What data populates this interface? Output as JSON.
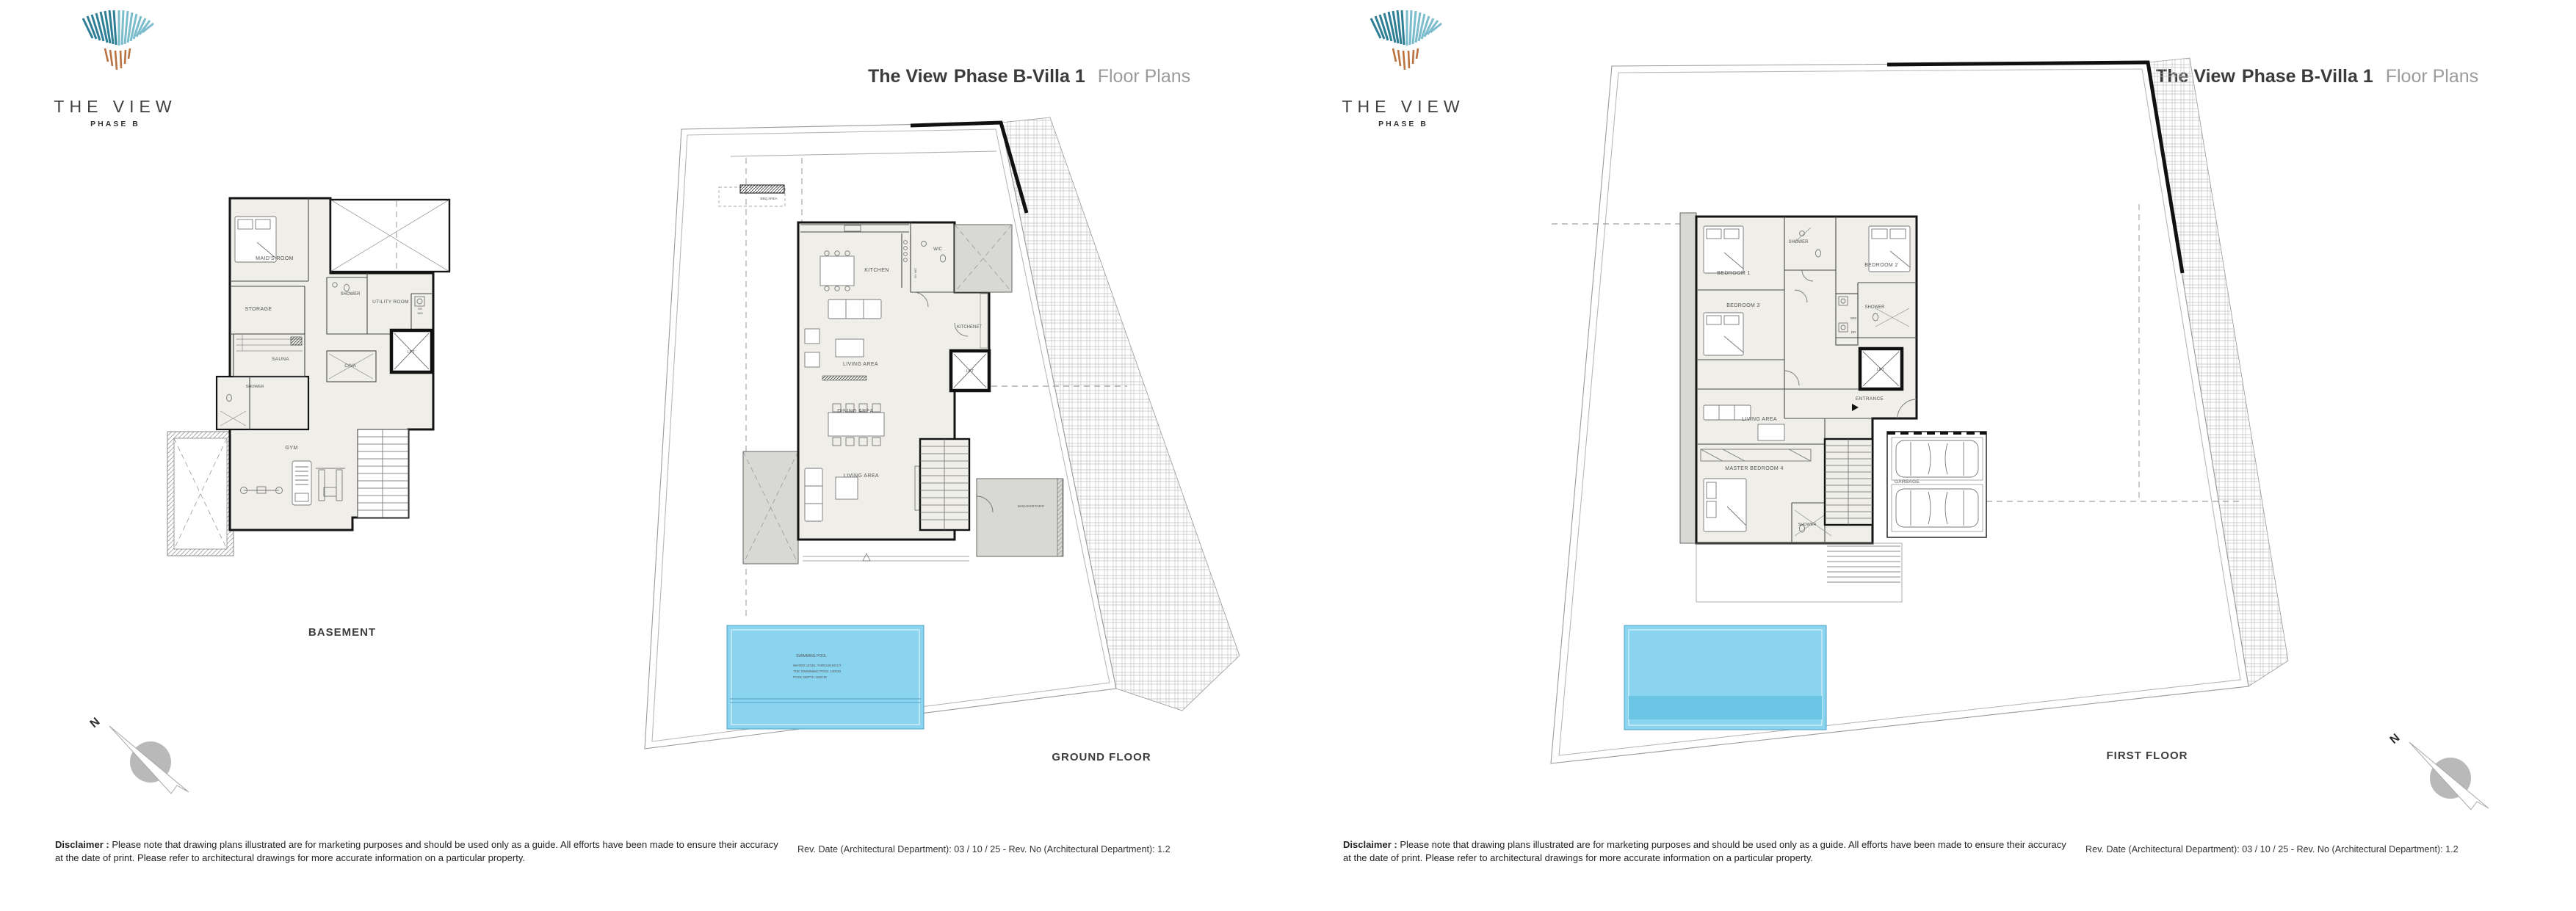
{
  "branding": {
    "logo_title": "THE VIEW",
    "logo_subtitle": "PHASE B"
  },
  "title": {
    "project": "The View",
    "unit": "Phase B-Villa 1",
    "suffix": "Floor Plans"
  },
  "compass": {
    "north": "N"
  },
  "footer": {
    "disclaimer_label": "Disclaimer :",
    "disclaimer_text": " Please note that drawing plans illustrated are for marketing purposes and should be used only as a guide. All efforts have been made to ensure their accuracy at the date of print. Please refer to architectural drawings for more accurate information on a particular property.",
    "revision": "Rev. Date (Architectural Department): 03 / 10 / 25 - Rev. No (Architectural Department): 1.2"
  },
  "colors": {
    "pool": "#8BD4EF",
    "pool_deep": "#6CC4E4",
    "roof_gray": "#D8D8D4",
    "teal_dark": "#2E7F95",
    "teal_light": "#7CBDCD",
    "orange": "#B97240"
  },
  "plans": {
    "basement": {
      "caption": "BASEMENT",
      "rooms": {
        "maids_room": "MAID'S ROOM",
        "storage": "STORAGE",
        "shower_top": "SHOWER",
        "utility_room": "UTILITY ROOM",
        "dr": "DR",
        "wm": "WM",
        "sauna": "SAUNA",
        "cava": "CAVA",
        "lift": "LIFT",
        "shower_lower": "SHOWER",
        "gym": "GYM"
      }
    },
    "ground": {
      "caption": "GROUND FLOOR",
      "rooms": {
        "kitchen": "KITCHEN",
        "wc": "W/C",
        "kitchenet": "KITCHENET",
        "lift": "LIFT",
        "living_upper": "LIVING AREA",
        "dining": "DINING AREA",
        "living_lower": "LIVING AREA",
        "plant_room": "ΜΗΧΑΝΟΣΤΑΣΙΟ",
        "bbq": "BBQ AREA",
        "appliances": "OV MIC"
      },
      "pool": {
        "title": "SWIMMING POOL",
        "note_line1": "WATER LEVEL THROUGHOUT",
        "note_line2": "THE SWIMMING POOL 140CM",
        "note_line3": "POOL DEPTH 150CM"
      }
    },
    "first": {
      "caption": "FIRST FLOOR",
      "rooms": {
        "bedroom1": "BEDROOM 1",
        "shower_top": "SHOWER",
        "bedroom2": "BEDROOM 2",
        "bedroom3": "BEDROOM 3",
        "shower_mid": "SHOWER",
        "wm": "WM",
        "dr": "DR",
        "lift": "LIFT",
        "entrance": "ENTRANCE",
        "living": "LIVING AREA",
        "master": "MASTER BEDROOM 4",
        "shower_lower": "SHOWER",
        "garage": "GARBAGE"
      }
    }
  }
}
